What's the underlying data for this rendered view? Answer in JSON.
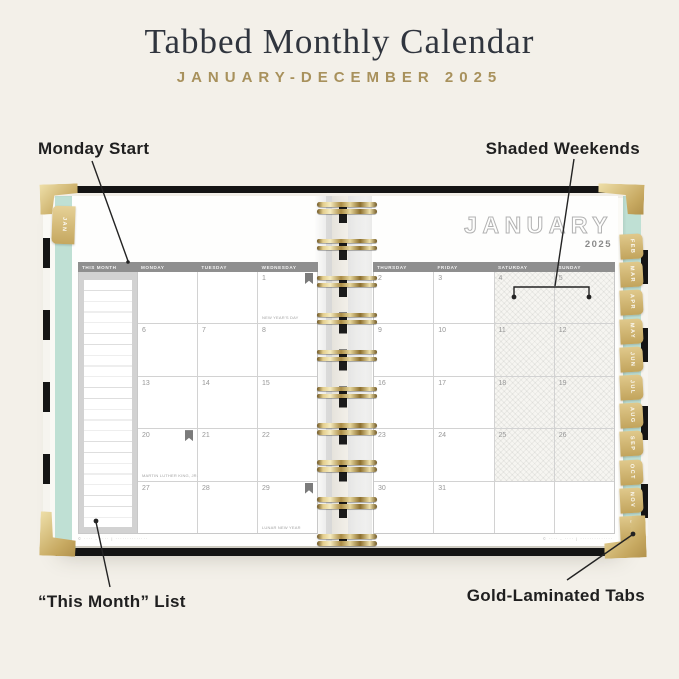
{
  "title": "Tabbed Monthly Calendar",
  "subtitle": "JANUARY-DECEMBER 2025",
  "callouts": {
    "monday_start": "Monday Start",
    "shaded_weekends": "Shaded Weekends",
    "this_month_list": "“This Month” List",
    "gold_tabs": "Gold-Laminated Tabs"
  },
  "planner": {
    "month": "JANUARY",
    "year": "2025",
    "tabs": {
      "left": "JAN",
      "right": [
        "FEB",
        "MAR",
        "APR",
        "MAY",
        "JUN",
        "JUL",
        "AUG",
        "SEP",
        "OCT",
        "NOV",
        "DEC"
      ]
    },
    "left_page": {
      "columns": [
        "THIS MONTH",
        "MONDAY",
        "TUESDAY",
        "WEDNESDAY"
      ],
      "weeks": [
        [
          "",
          "",
          "1"
        ],
        [
          "6",
          "7",
          "8"
        ],
        [
          "13",
          "14",
          "15"
        ],
        [
          "20",
          "21",
          "22"
        ],
        [
          "27",
          "28",
          "29"
        ]
      ],
      "holidays": [
        {
          "date": "1",
          "label": "NEW YEAR'S DAY"
        },
        {
          "date": "20",
          "label": "MARTIN LUTHER KING, JR. DAY"
        },
        {
          "date": "29",
          "label": "LUNAR NEW YEAR"
        }
      ],
      "flagged_dates": [
        "1",
        "20",
        "29"
      ],
      "footer": "© ···· - ···· | ··············"
    },
    "right_page": {
      "columns": [
        "THURSDAY",
        "FRIDAY",
        "SATURDAY",
        "SUNDAY"
      ],
      "weeks": [
        [
          "2",
          "3",
          "4",
          "5"
        ],
        [
          "9",
          "10",
          "11",
          "12"
        ],
        [
          "16",
          "17",
          "18",
          "19"
        ],
        [
          "23",
          "24",
          "25",
          "26"
        ],
        [
          "30",
          "31",
          "",
          ""
        ]
      ],
      "shaded_column_indexes": [
        2,
        3
      ],
      "footer": "© ···· - ···· | ··············"
    },
    "colors": {
      "gold": "#cfae63",
      "mint": "#bfe0d4",
      "cover_black": "#141414",
      "header_gray": "#8f8f8f"
    }
  }
}
